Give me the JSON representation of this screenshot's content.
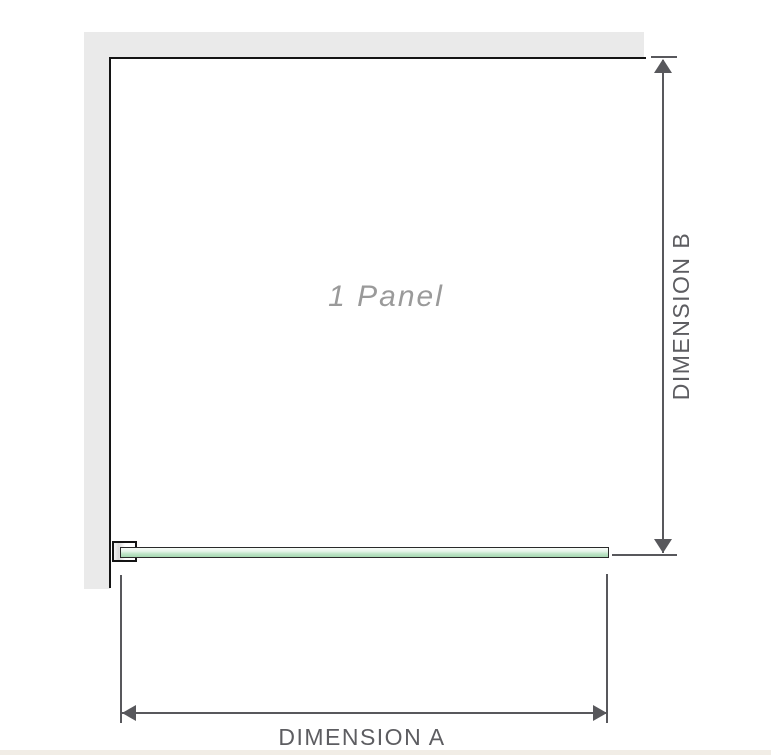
{
  "diagram": {
    "panel_label": "1 Panel",
    "dimension_a": {
      "label": "DIMENSION A",
      "orientation": "horizontal"
    },
    "dimension_b": {
      "label": "DIMENSION B",
      "orientation": "vertical"
    }
  },
  "icons": {
    "dimension_b_arrows": [
      "arrow-up-icon",
      "arrow-down-icon"
    ],
    "dimension_a_arrows": [
      "arrow-left-icon",
      "arrow-right-icon"
    ]
  },
  "colors": {
    "background": "#ffffff",
    "wall_fill": "#eaeaea",
    "panel_outline": "#141414",
    "dimension_gray": "#58585c",
    "dimension_text": "#5d5d61",
    "panel_label_text": "#9a9a9a",
    "glass_green_light": "#e7f5ea",
    "glass_green_dark": "#a5d8b0",
    "glass_edge": "#2a2a2a",
    "footer_strip": "#f1ede6"
  }
}
